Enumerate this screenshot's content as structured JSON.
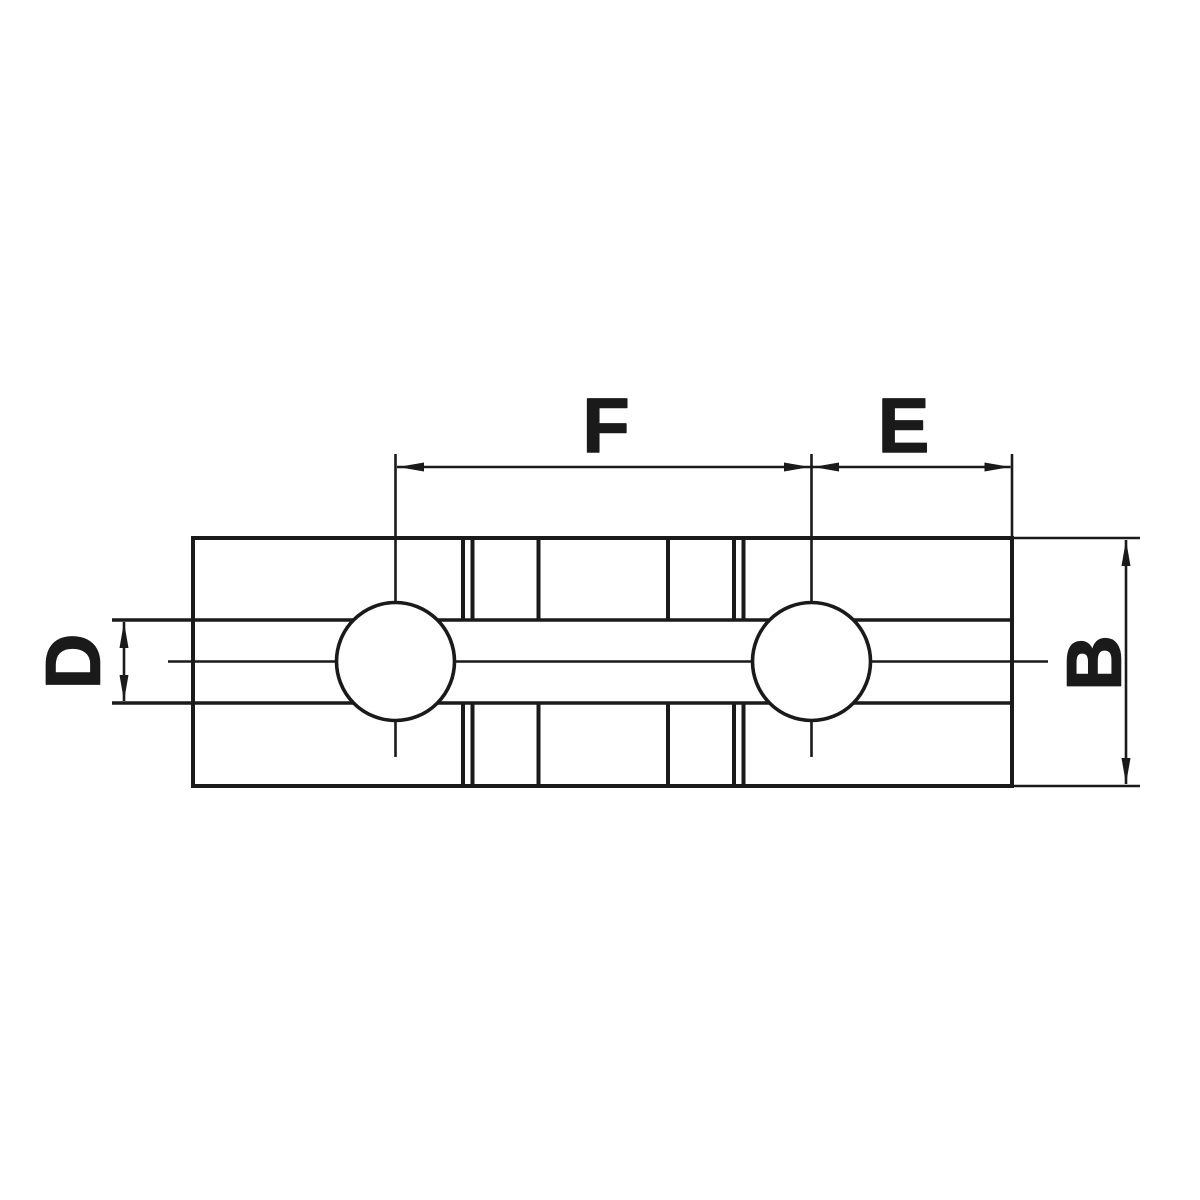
{
  "diagram": {
    "background_color": "#ffffff",
    "line_color": "#1a1a1a",
    "dimension_labels": {
      "f": "F",
      "e": "E",
      "d": "D",
      "b": "B"
    }
  }
}
